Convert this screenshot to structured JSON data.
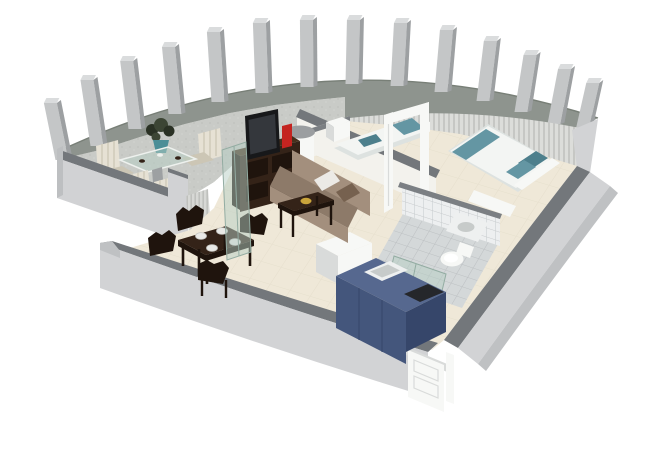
{
  "scene": {
    "type": "isometric-3d-floor-plan-render",
    "background": "#ffffff",
    "rooms": [
      "terrace",
      "living-room",
      "dining-area",
      "bedroom",
      "bathroom",
      "kitchen",
      "entry"
    ],
    "objects": {
      "terrace": [
        "curved-colonnade-wall",
        "pillars",
        "parapet",
        "glass-table",
        "potted-plant",
        "cream-outdoor-chairs",
        "louver-screen"
      ],
      "living_room": [
        "sofa",
        "white-cushion",
        "brown-cushion",
        "coffee-table",
        "gold-bowl",
        "tv-cabinet",
        "flat-screen-tv",
        "red-vase",
        "glass-door-panel",
        "round-column"
      ],
      "dining_area": [
        "dark-dining-table",
        "dining-chairs",
        "plates"
      ],
      "bedroom": [
        "single-bed",
        "double-bed",
        "teal-bedding",
        "teal-pillows",
        "white-cabinet",
        "foot-bench",
        "open-door-frame",
        "curtains"
      ],
      "bathroom": [
        "tiled-walls",
        "tiled-floor",
        "washbasin",
        "toilet",
        "glass-shower-screen"
      ],
      "kitchen": [
        "blue-cabinet-unit",
        "white-counter",
        "sink",
        "black-cooktop"
      ],
      "entry": [
        "white-panel-door"
      ]
    },
    "counts": {
      "pillars": 14,
      "dining_chairs": 4,
      "plates": 4,
      "beds": 2,
      "outdoor_chairs": 4
    }
  },
  "palette": {
    "bg": "#ffffff",
    "band": "#8e948e",
    "band_edge": "#787f77",
    "pillar_front": "#c4c6c7",
    "pillar_side": "#9da0a2",
    "pillar_top": "#dadcdd",
    "terrace_floor": "#c9cbc7",
    "parapet_cap": "#73777b",
    "parapet_face": "#d1d2d4",
    "parapet_face_dark": "#bdbfc1",
    "curtain_a": "#dcddda",
    "curtain_b": "#c6c7c4",
    "wall_cap": "#73777b",
    "wall_face": "#d2d3d5",
    "wall_face_dark": "#bfc1c3",
    "wall_inner": "#f0efe9",
    "floor": "#efe8d8",
    "floor_line": "#e4ddcb",
    "partition": "#f3f2ed",
    "partition_cap": "#7b7f83",
    "white_obj": "#f7f8f6",
    "white_obj_shadow": "#d9dbda",
    "espresso": "#342318",
    "espresso_dark": "#1f140d",
    "espresso_top": "#46301d",
    "sofa": "#a38f7d",
    "sofa_dark": "#8d7a69",
    "pillow_white": "#eceae6",
    "pillow_dark": "#76614f",
    "teal": "#6496a3",
    "teal_dark": "#4d7f8c",
    "bed_white": "#f3f5f3",
    "bed_shadow": "#dde2e0",
    "tv_frame": "#17181a",
    "tv_screen": "#34373c",
    "red_accent": "#c42420",
    "gold": "#c9a43b",
    "kitchen_top": "#56688f",
    "kitchen_front": "#44567c",
    "kitchen_side": "#36466a",
    "cooktop": "#25272b",
    "sink_white": "#eef0f0",
    "sink_inner": "#c7cbca",
    "tile_floor": "#d4d8d9",
    "tile_wall": "#edeff0",
    "tile_line": "#bcc0c2",
    "glass": "#b5cdc3",
    "glass_edge": "#93aca2",
    "plant": "#3c4534",
    "plant_dark": "#2a3124",
    "pot": "#4b8e97",
    "chair_cream": "#e6e1d4",
    "chair_cream_dark": "#ccc6b5",
    "column_cap": "#9b9ea0"
  },
  "structure": {
    "pillars": [
      [
        62,
        160,
        57
      ],
      [
        97,
        146,
        66
      ],
      [
        135,
        129,
        68
      ],
      [
        175,
        114,
        67
      ],
      [
        218,
        102,
        70
      ],
      [
        262,
        93,
        70
      ],
      [
        307,
        87,
        67
      ],
      [
        352,
        84,
        64
      ],
      [
        397,
        86,
        63
      ],
      [
        441,
        92,
        62
      ],
      [
        483,
        101,
        60
      ],
      [
        521,
        112,
        57
      ],
      [
        554,
        124,
        55
      ],
      [
        581,
        135,
        52
      ]
    ]
  }
}
